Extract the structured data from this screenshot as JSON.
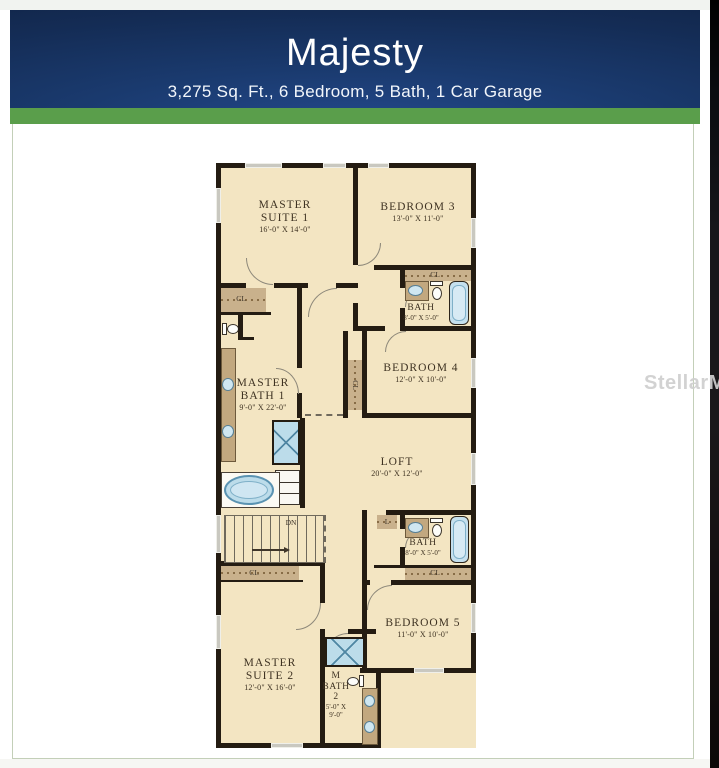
{
  "header": {
    "title": "Majesty",
    "subtitle": "3,275 Sq. Ft., 6 Bedroom, 5 Bath, 1 Car Garage"
  },
  "watermark": "StellarMLS",
  "plan": {
    "rooms": {
      "master_suite_1": {
        "line1": "MASTER",
        "line2": "SUITE 1",
        "dims": "16'-0\" X 14'-0\""
      },
      "bedroom_3": {
        "name": "BEDROOM 3",
        "dims": "13'-0\" X 11'-0\""
      },
      "bath_upper": {
        "name": "BATH",
        "dims": "8'-0\" X 5'-0\""
      },
      "bedroom_4": {
        "name": "BEDROOM 4",
        "dims": "12'-0\" X 10'-0\""
      },
      "master_bath_1": {
        "line1": "MASTER",
        "line2": "BATH 1",
        "dims": "9'-0\" X 22'-0\""
      },
      "loft": {
        "name": "LOFT",
        "dims": "20'-0\" X 12'-0\""
      },
      "bath_lower": {
        "name": "BATH",
        "dims": "8'-0\" X 5'-0\""
      },
      "bedroom_5": {
        "name": "BEDROOM 5",
        "dims": "11'-0\" X 10'-0\""
      },
      "master_suite_2": {
        "line1": "MASTER",
        "line2": "SUITE 2",
        "dims": "12'-0\" X 16'-0\""
      },
      "m_bath_2": {
        "line1": "M",
        "line2": "BATH",
        "line3": "2",
        "dims1": "5'-0\" X",
        "dims2": "9'-0\""
      }
    },
    "labels": {
      "closet": "CL",
      "linen": "L",
      "stairs_down": "DN"
    }
  },
  "colors": {
    "header_navy": "#15305c",
    "band_green": "#5a9e4b",
    "floor_cream": "#f3e5c2",
    "wall_black": "#241c12",
    "closet_brown": "#c9b18c",
    "fixture_blue": "#bcdcea"
  }
}
